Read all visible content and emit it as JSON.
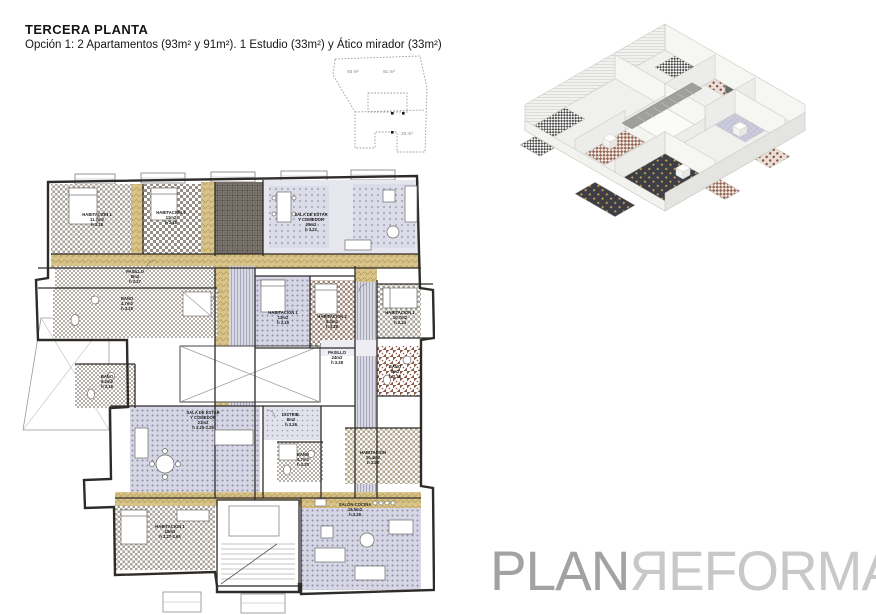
{
  "header": {
    "title": "TERCERA PLANTA",
    "subtitle": "Opción 1: 2 Apartamentos (93m² y 91m²). 1 Estudio (33m²) y Ático mirador (33m²)"
  },
  "keyplan": {
    "areas": {
      "left": "93 m²",
      "right": "91 m²",
      "bottom": "33 m²"
    }
  },
  "plan": {
    "rooms": [
      {
        "name": "HABITACIÓN 1",
        "area": "11.7m2",
        "h": "h 3.18"
      },
      {
        "name": "HABITACIÓN 2",
        "area": "11m2",
        "h": "h 3.18"
      },
      {
        "name": "SALA DE ESTAR",
        "name2": "Y COMEDOR",
        "area": "29m2",
        "h": "h 3.22"
      },
      {
        "name": "PASILLO",
        "area": "8m2",
        "h": "h 3.27"
      },
      {
        "name": "BAÑO",
        "area": "4.7m2",
        "h": "h 3.18"
      },
      {
        "name": "HABITACIÓN 1",
        "area": "13m2",
        "h": "h 3.19"
      },
      {
        "name": "HABITACIÓN 2",
        "area": "8.3m2",
        "h": "h 3.28"
      },
      {
        "name": "HABITACIÓN 1",
        "area": "10.7m2",
        "h": "h 3.24"
      },
      {
        "name": "BAÑO",
        "area": "6.2m2",
        "h": "h 3.18"
      },
      {
        "name": "PASILLO",
        "area": "24m2",
        "h": "h 3.28"
      },
      {
        "name": "BAÑO",
        "area": "5m2",
        "h": "h 3.28"
      },
      {
        "name": "SALA DE ESTAR",
        "name2": "Y COMEDOR",
        "area": "21m2",
        "h": "h 3.25-3.28"
      },
      {
        "name": "DISTRIB.",
        "area": "8m2",
        "h": "h 3.26"
      },
      {
        "name": "BAÑO",
        "area": "4.7m2",
        "h": "h 3.28"
      },
      {
        "name": "HABITACIÓN",
        "area": "10.4m2",
        "h": "h 3.28"
      },
      {
        "name": "HABITACIÓN 1",
        "area": "15m2",
        "h": "h 3.27-2.65"
      },
      {
        "name": "SALÓN-COCINA",
        "area": "18.5m2",
        "h": "h 3.28"
      }
    ]
  },
  "palette": {
    "corridor_tan": "#d9c58c",
    "living_lilac": "#dcdce8",
    "bedroom_checker": "#a9a39b",
    "bath_brown": "#8a5948",
    "wall_line": "#2e2b28",
    "logo_plan": "#a2a2a2",
    "logo_reforma": "#c8c8c8"
  },
  "watermark": {
    "plan": "PLAN",
    "reforma": "ЯEFORMA"
  }
}
